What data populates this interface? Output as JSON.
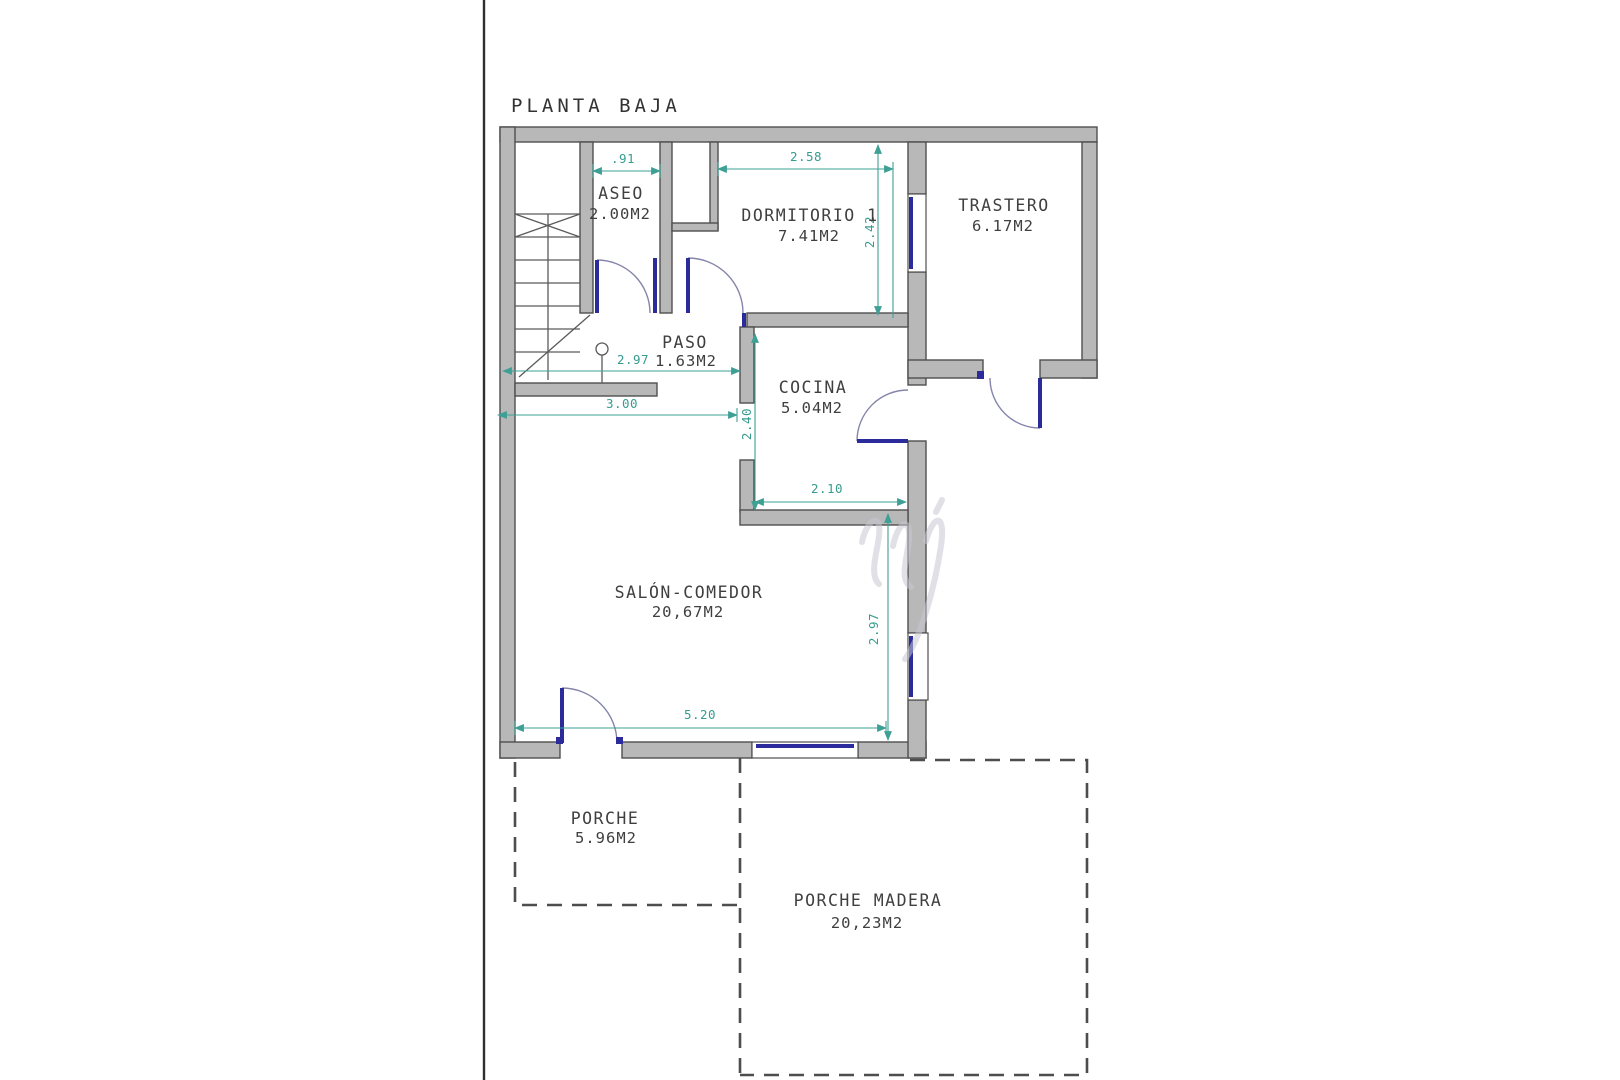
{
  "drawing": {
    "title": "PLANTA BAJA"
  },
  "rooms": {
    "aseo": {
      "name": "ASEO",
      "area": "2.00M2"
    },
    "dormitorio": {
      "name": "DORMITORIO 1",
      "area": "7.41M2"
    },
    "trastero": {
      "name": "TRASTERO",
      "area": "6.17M2"
    },
    "paso": {
      "name": "PASO",
      "area": "1.63M2"
    },
    "cocina": {
      "name": "COCINA",
      "area": "5.04M2"
    },
    "salon": {
      "name": "SALÓN-COMEDOR",
      "area": "20,67M2"
    },
    "porche": {
      "name": "PORCHE",
      "area": "5.96M2"
    },
    "porche_madera": {
      "name": "PORCHE MADERA",
      "area": "20,23M2"
    }
  },
  "dimensions": {
    "aseo_width": ".91",
    "dormitorio_width": "2.58",
    "dormitorio_depth": "2.42",
    "paso_width": "2.97",
    "hall_width": "3.00",
    "cocina_depth": "2.40",
    "cocina_width": "2.10",
    "salon_depth": "2.97",
    "salon_width": "5.20"
  },
  "colors": {
    "wall_fill": "#b8b8b8",
    "wall_stroke": "#4f4f4f",
    "dimension": "#3ea094",
    "door_window": "#2b2b9b",
    "dashed_outline": "#4d4d4d",
    "text": "#3f3f3f"
  }
}
